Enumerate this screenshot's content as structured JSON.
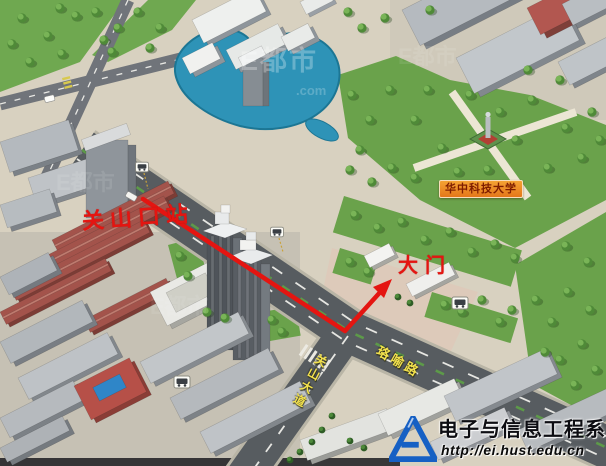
{
  "map": {
    "station_label": "关山口站",
    "gate_label": "大门",
    "university_label": "华中科技大学",
    "roads": {
      "guanshan": "关山大道",
      "luoyu": "珞喻路"
    },
    "watermark": {
      "brand": "E都市",
      "suffix": ".com"
    }
  },
  "footer": {
    "department": "电子与信息工程系",
    "url": "http://ei.hust.edu.cn"
  },
  "icons": {
    "bus_stop": "bus-stop-icon",
    "logo": "ei-department-logo-icon"
  },
  "colors": {
    "route_red": "#e41511",
    "lake_blue": "#2e93b7",
    "label_orange": "#ef8c1c",
    "road_name_yellow": "#f2e14d",
    "logo_blue": "#1660c4"
  }
}
